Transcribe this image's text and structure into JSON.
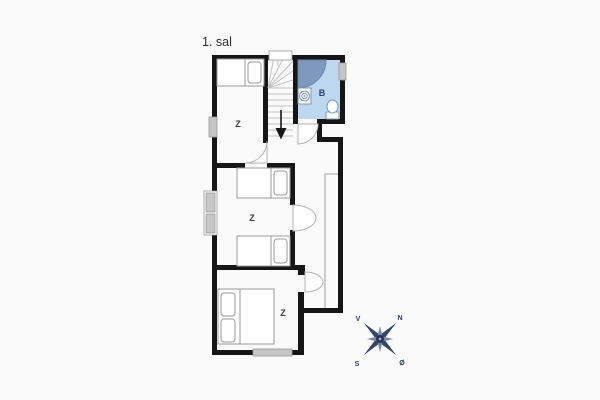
{
  "page": {
    "background": "#fafafa"
  },
  "plan": {
    "title": "1. sal",
    "rooms": [
      {
        "id": "bedroom-top",
        "label": "Z"
      },
      {
        "id": "bedroom-middle",
        "label": "Z"
      },
      {
        "id": "bedroom-bottom",
        "label": "Z"
      },
      {
        "id": "bathroom",
        "label": "B"
      }
    ],
    "icons": [
      "stairs-icon",
      "stairs-down-arrow-icon",
      "shower-icon",
      "sink-icon",
      "toilet-icon",
      "single-bed-icon",
      "double-bed-icon",
      "window-icon",
      "door-swing-icon",
      "compass-rose-icon"
    ],
    "colors": {
      "wall": "#161616",
      "window_fill": "#c6c6c6",
      "bathroom_floor": "#bdd8ee",
      "shower": "#7e99bd",
      "shower_edge": "#6687ad",
      "fixture_outline": "#7c98ba",
      "bathroom_label": "#27416e",
      "furniture_outline": "#9a9a9a",
      "door_arc": "#b3b3b3",
      "stair_lines": "#c2c2c2",
      "ceiling_line": "#b5b5b5",
      "compass_primary": "#36466a",
      "compass_secondary": "#7486ab"
    }
  },
  "compass": {
    "north": "N",
    "south": "S",
    "east": "Ø",
    "west": "V"
  }
}
